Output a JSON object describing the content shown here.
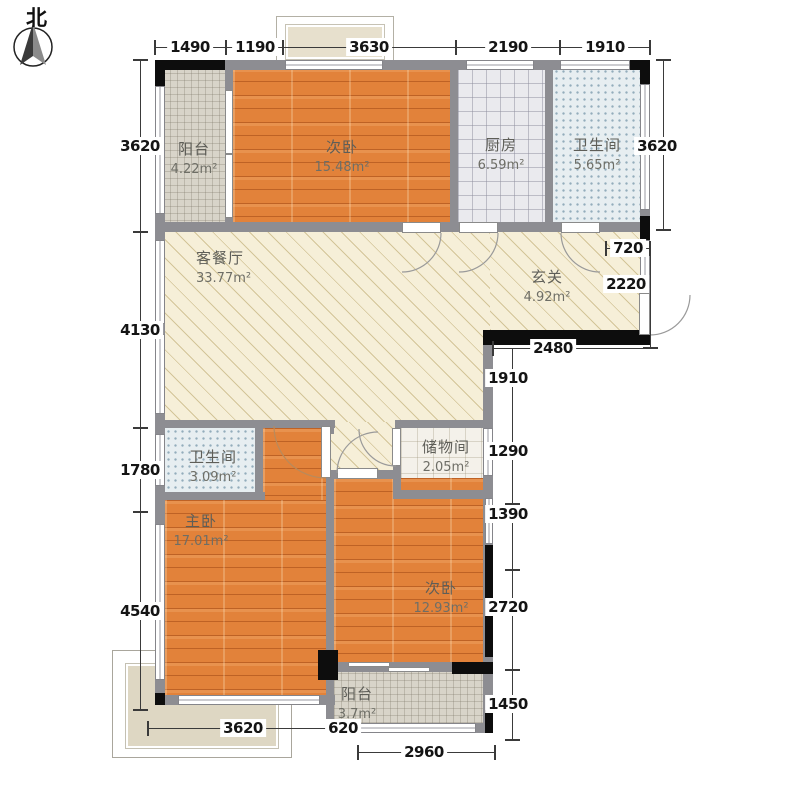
{
  "compass": {
    "north_label": "北"
  },
  "rooms": [
    {
      "id": "balcony-top",
      "name": "阳台",
      "area": "4.22m²"
    },
    {
      "id": "bedroom-top",
      "name": "次卧",
      "area": "15.48m²"
    },
    {
      "id": "kitchen",
      "name": "厨房",
      "area": "6.59m²"
    },
    {
      "id": "bathroom-top",
      "name": "卫生间",
      "area": "5.65m²"
    },
    {
      "id": "living-dining",
      "name": "客餐厅",
      "area": "33.77m²"
    },
    {
      "id": "foyer",
      "name": "玄关",
      "area": "4.92m²"
    },
    {
      "id": "bathroom-mid",
      "name": "卫生间",
      "area": "3.09m²"
    },
    {
      "id": "storage",
      "name": "储物间",
      "area": "2.05m²"
    },
    {
      "id": "master-bedroom",
      "name": "主卧",
      "area": "17.01m²"
    },
    {
      "id": "bedroom-bottom",
      "name": "次卧",
      "area": "12.93m²"
    },
    {
      "id": "balcony-bottom",
      "name": "阳台",
      "area": "3.7m²"
    }
  ],
  "dimensions": {
    "top": [
      "1490",
      "1190",
      "3630",
      "2190",
      "1910"
    ],
    "left": [
      "3620",
      "4130",
      "1780",
      "4540"
    ],
    "right_outer": [
      "3620",
      "720",
      "2220",
      "2480"
    ],
    "right_inner": [
      "1910",
      "1290",
      "1390",
      "2720",
      "1450"
    ],
    "bottom": [
      "3620",
      "620",
      "2960"
    ]
  },
  "colors": {
    "wall": "#8d8d92",
    "wall_structural": "#0d0d0d",
    "wood_floor": "#e2823a",
    "living_floor": "#f6efd8",
    "balcony_tile": "#d8d4c9",
    "kitchen_tile": "#eaeaee",
    "bath_tile": "#e7eef1"
  }
}
